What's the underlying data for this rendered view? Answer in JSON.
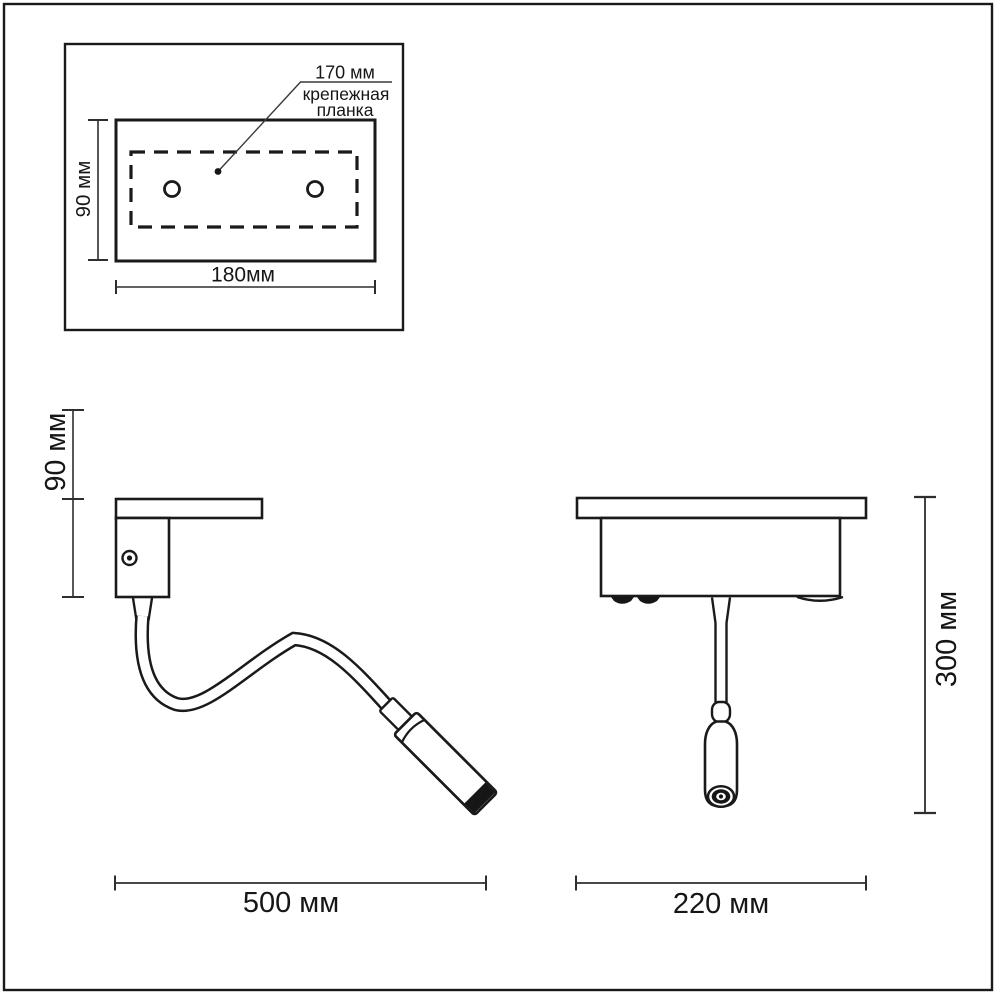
{
  "drawing": {
    "top_view": {
      "callout_dimension": "170 мм",
      "callout_line1": "крепежная",
      "callout_line2": "планка",
      "height_dimension": "90 мм",
      "width_dimension": "180мм"
    },
    "side_view": {
      "height_dimension": "90 мм",
      "width_dimension": "500 мм"
    },
    "front_view": {
      "height_dimension": "300 мм",
      "width_dimension": "220 мм"
    },
    "colors": {
      "line": "#1a1a1a",
      "dimension_line": "#2e2e2e",
      "text": "#161616",
      "background": "#ffffff"
    }
  }
}
